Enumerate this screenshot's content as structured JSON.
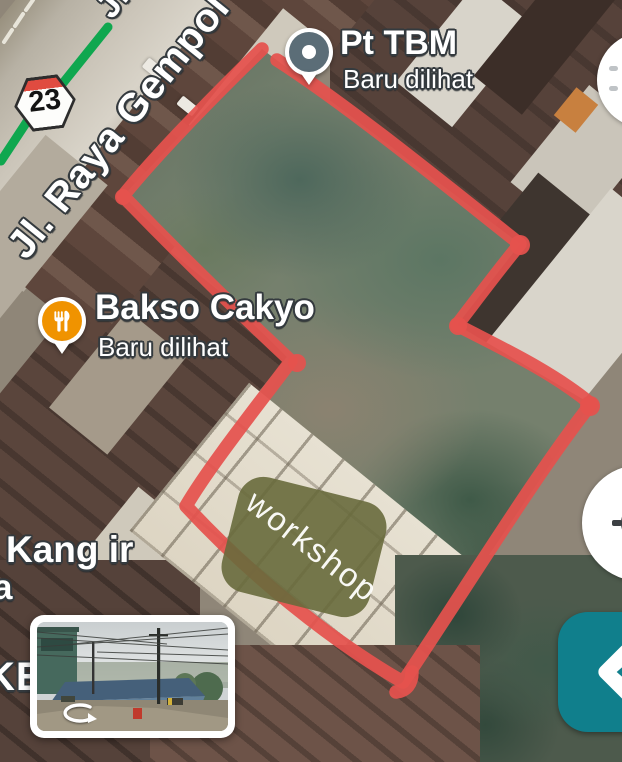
{
  "colors": {
    "annotation_red": "#e5524e",
    "annotation_olive": "#686b3c",
    "directions_teal": "#107f8c",
    "poi_orange": "#f09300",
    "poi_pin_gray": "#5b6d77",
    "transit_green": "#0fa74f",
    "route_badge_red": "#e04b40"
  },
  "roads": {
    "top_label": "Jl. ",
    "main_label": "Jl. Raya Gempol",
    "route_badge": "23"
  },
  "pois": [
    {
      "name": "Pt TBM",
      "subtitle": "Baru dilihat",
      "icon": "map-pin-icon"
    },
    {
      "name": "Bakso Cakyo",
      "subtitle": "Baru dilihat",
      "icon": "restaurant-icon"
    }
  ],
  "place_labels": [
    {
      "text": "Kang ir"
    },
    {
      "text": "a"
    },
    {
      "text": "KE"
    }
  ],
  "annotation": {
    "label": "workshop"
  },
  "controls": {
    "top_right_button_icon": "partial-circle-button",
    "locate_button_icon": "my-location-icon",
    "directions_button_icon": "directions-arrow-icon"
  },
  "street_view": {
    "rotate_icon": "pan-rotate-icon"
  }
}
